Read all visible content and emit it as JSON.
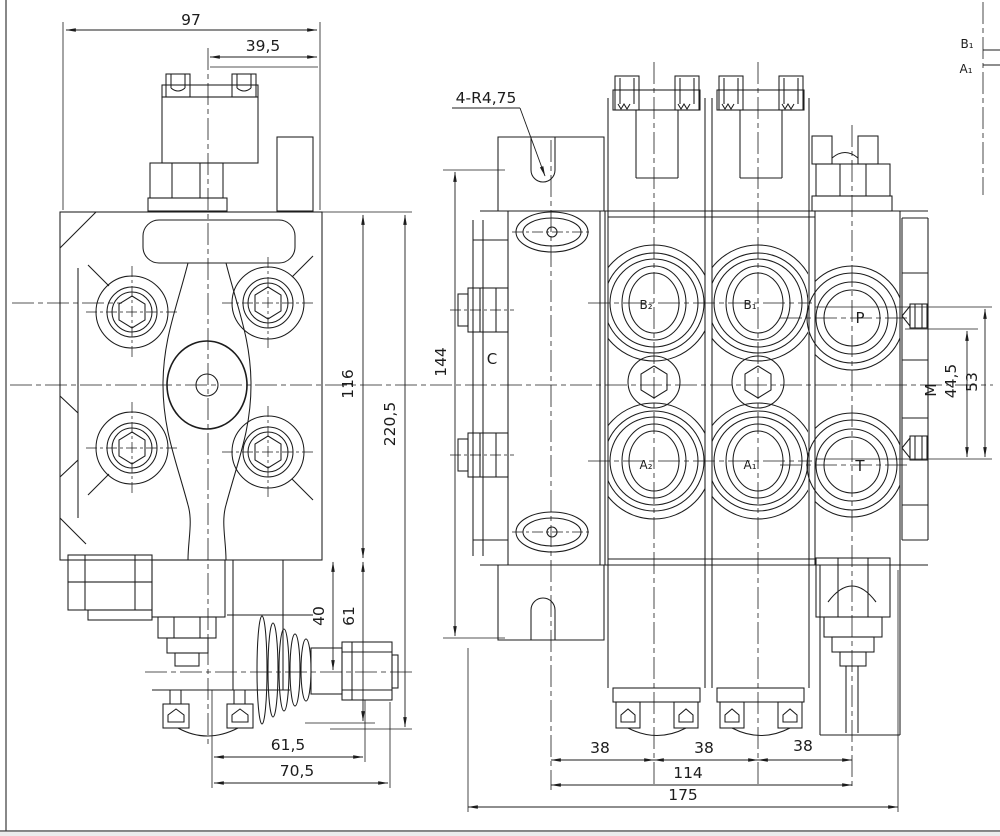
{
  "palette": {
    "ink": "#1c1c1c",
    "paper": "#ffffff"
  },
  "left_view": {
    "dim_width_total": "97",
    "dim_width_partial": "39,5",
    "dim_height_body": "116",
    "dim_height_total": "220,5",
    "dim_boot_height": "40",
    "dim_lever_height": "61",
    "dim_bottom_inner": "61,5",
    "dim_bottom_outer": "70,5"
  },
  "front_view": {
    "slot_label": "4-R4,75",
    "dim_plate_height": "144",
    "inlet_label": "C",
    "port_b2": "B₂",
    "port_a2": "A₂",
    "port_b1": "B₁",
    "port_a1": "A₁",
    "port_p": "P",
    "port_t": "T",
    "gauge_label": "M",
    "dim_m_offset": "44,5",
    "dim_pt_span": "53",
    "dim_section_spacing_1": "38",
    "dim_section_spacing_2": "38",
    "dim_section_spacing_3": "38",
    "dim_bolt_span": "114",
    "dim_total_width": "175"
  },
  "corner_detail": {
    "port_b1": "B₁",
    "port_a1": "A₁"
  }
}
